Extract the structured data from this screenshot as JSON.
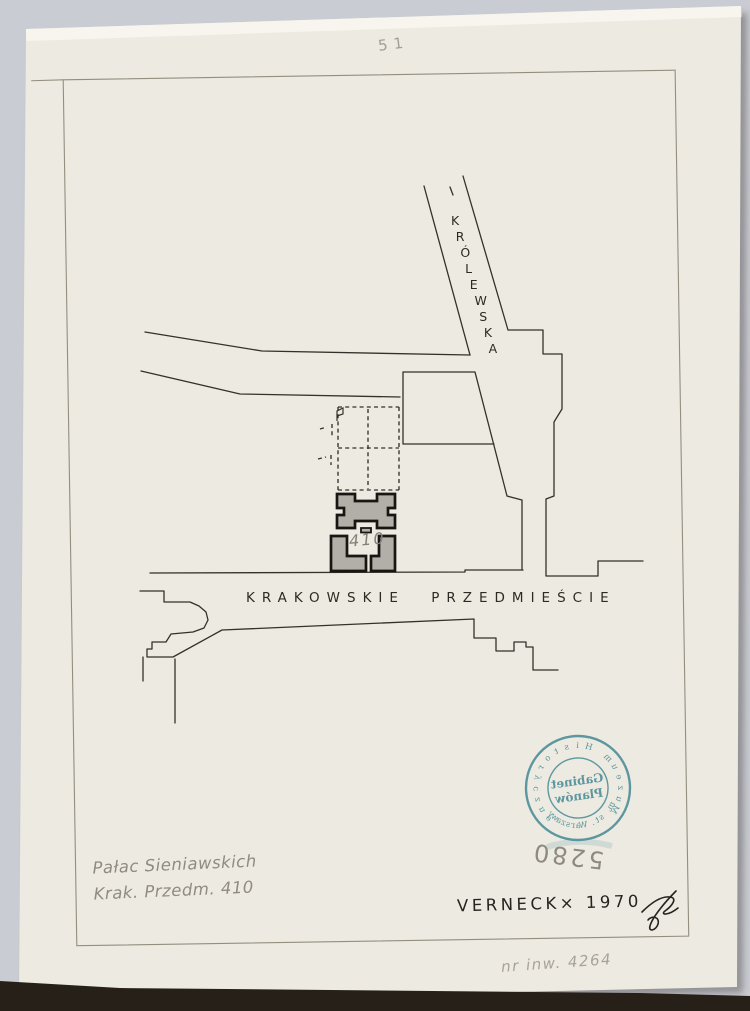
{
  "page": {
    "corner_number": "51"
  },
  "map": {
    "street_diagonal": {
      "label": "KRÓLEWSKA"
    },
    "street_horizontal": {
      "label": "KRAKOWSKIE PRZEDMIEŚCIE"
    },
    "building_number": "410"
  },
  "stamp": {
    "ring_top": "Muzeum Historyczne",
    "ring_bottom": "m. st. Warszawy",
    "center_line1": "Gabinet",
    "center_line2": "Planów",
    "number_below": "5280",
    "color": "#34808d",
    "mirrored": true
  },
  "annotations": {
    "caption_line1": "Pałac Sieniawskich",
    "caption_line2": "Krak. Przedm. 410",
    "author_year": "VERNECK× 1970",
    "inventory_number": "nr inw. 4264"
  },
  "colors": {
    "background": "#c9ccd2",
    "paper": "#edeae1",
    "ink": "#34312c",
    "pencil": "#8f8b83",
    "stamp_teal": "#34808d"
  }
}
